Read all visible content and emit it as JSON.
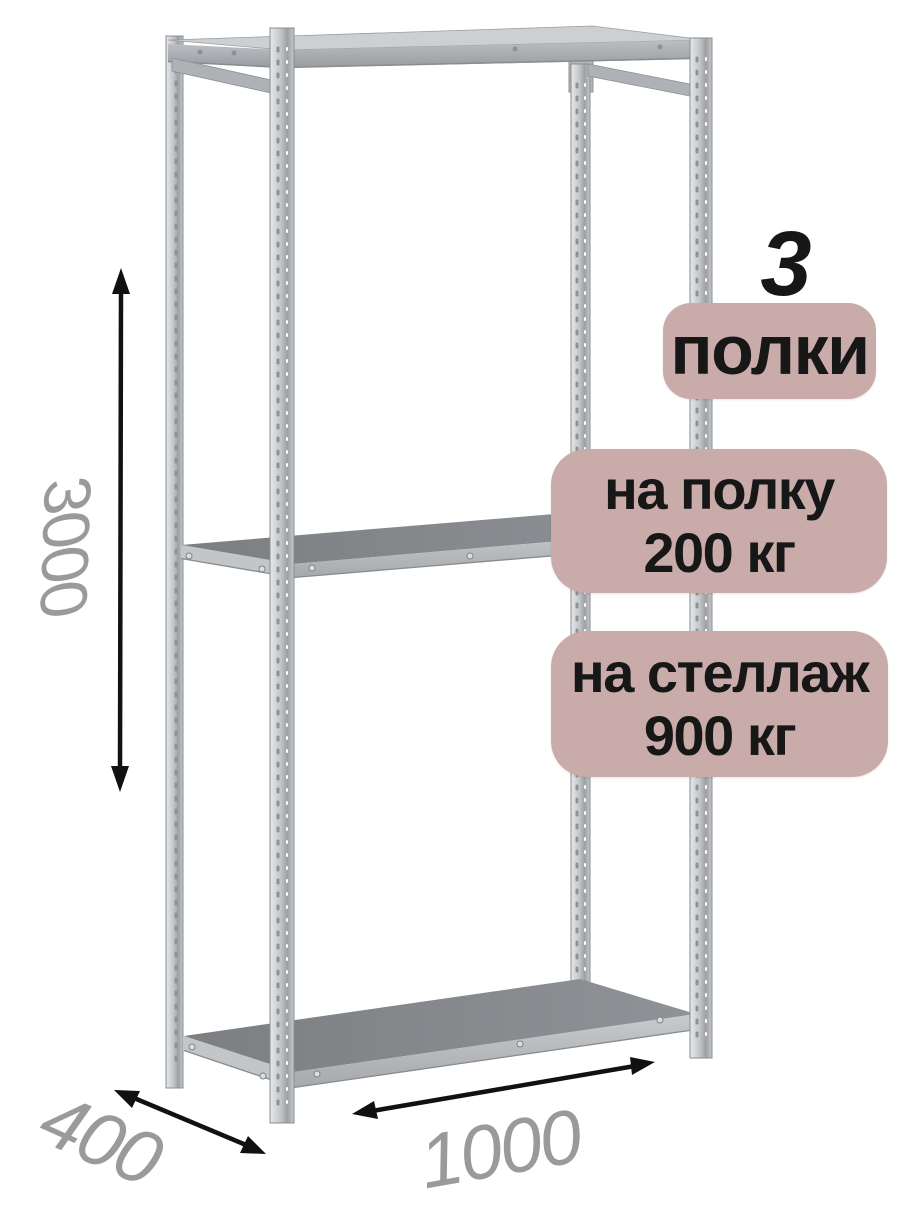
{
  "card": {
    "count": "3",
    "badges": {
      "shelves": "полки",
      "per_shelf": {
        "line1": "на полку",
        "line2": "200 кг"
      },
      "per_rack": {
        "line1": "на стеллаж",
        "line2": "900 кг"
      }
    },
    "dimensions": {
      "height_mm": "3000",
      "depth_mm": "400",
      "width_mm": "1000"
    }
  },
  "colors": {
    "background": "#ffffff",
    "badge_bg": "#c9abaa",
    "badge_text": "#171717",
    "dimension_text": "#9a9a9a",
    "arrow": "#111111",
    "metal_light": "#e3e5e7",
    "metal_mid": "#c2c5c8",
    "metal_dark": "#85888b",
    "shelf_surface": "#84878a"
  }
}
